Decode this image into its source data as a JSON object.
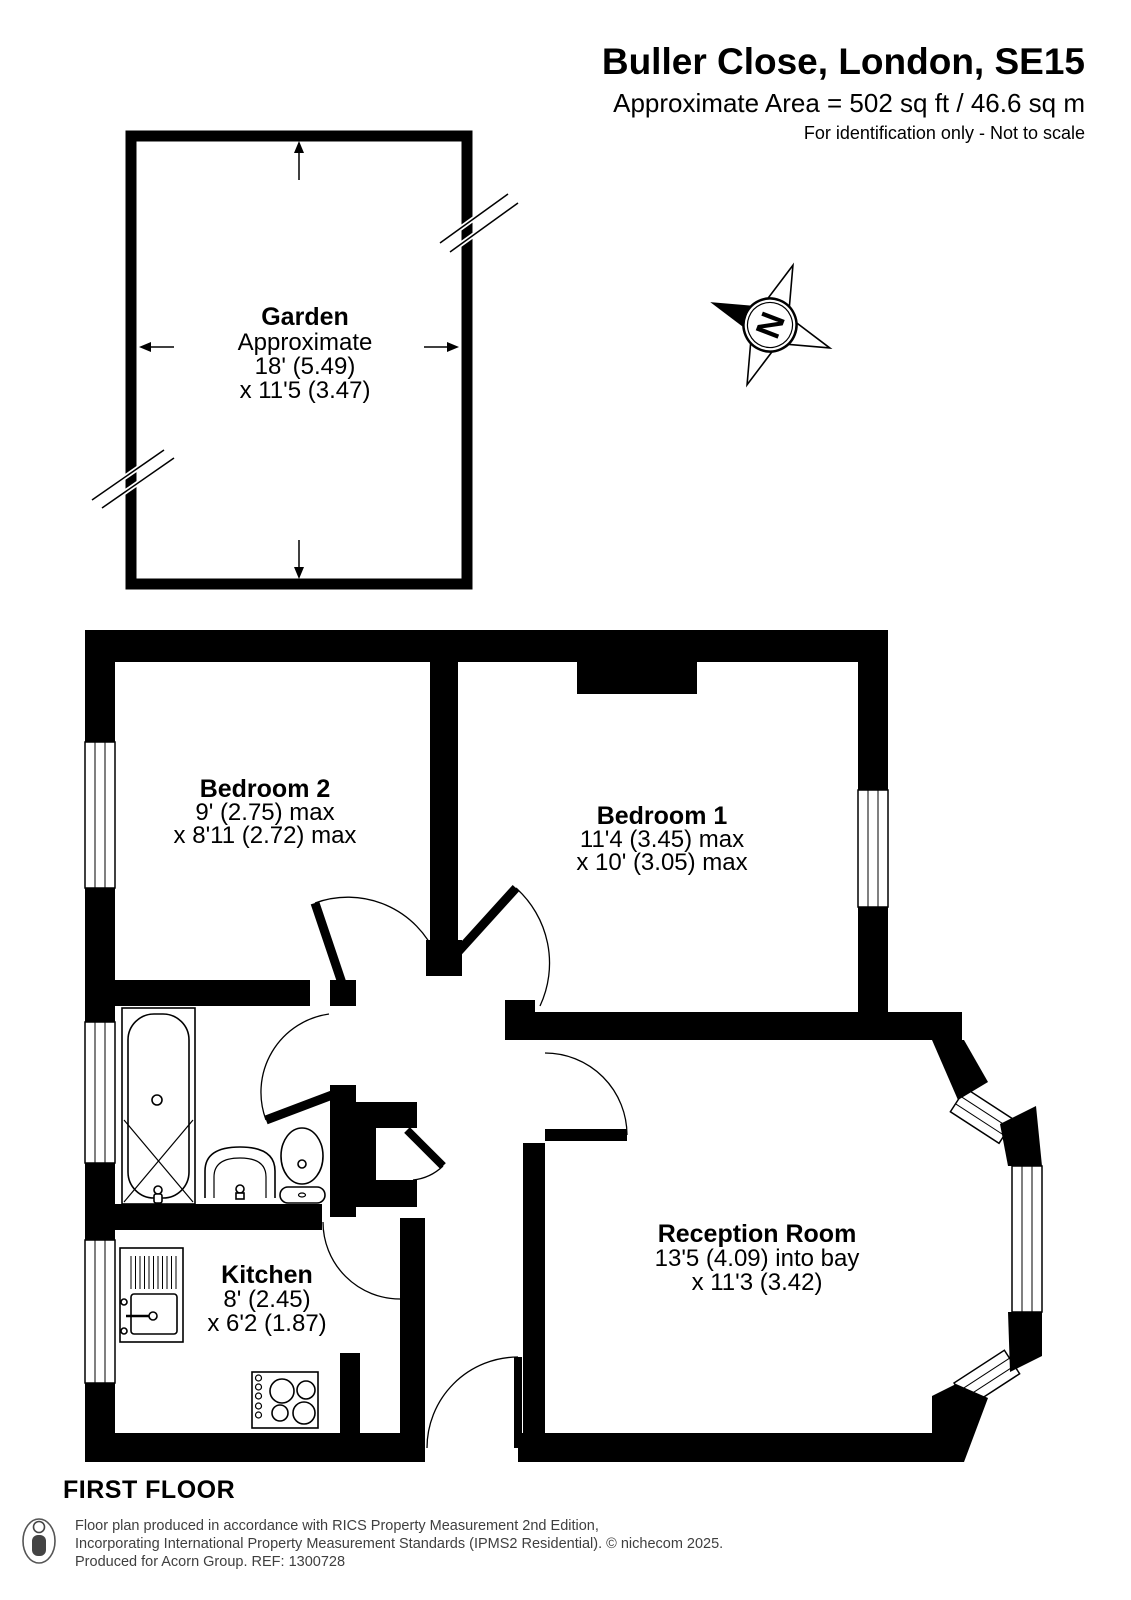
{
  "header": {
    "title": "Buller Close, London, SE15",
    "area": "Approximate Area = 502 sq ft / 46.6 sq m",
    "note": "For identification only - Not to scale"
  },
  "compass": {
    "north": "N"
  },
  "garden": {
    "name": "Garden",
    "line2": "Approximate",
    "line3": "18' (5.49)",
    "line4": "x 11'5 (3.47)"
  },
  "rooms": {
    "bedroom2": {
      "name": "Bedroom 2",
      "dim1": "9' (2.75) max",
      "dim2": "x 8'11 (2.72) max"
    },
    "bedroom1": {
      "name": "Bedroom 1",
      "dim1": "11'4 (3.45) max",
      "dim2": "x 10' (3.05) max"
    },
    "reception": {
      "name": "Reception Room",
      "dim1": "13'5 (4.09) into bay",
      "dim2": "x 11'3 (3.42)"
    },
    "kitchen": {
      "name": "Kitchen",
      "dim1": "8' (2.45)",
      "dim2": "x 6'2 (1.87)"
    }
  },
  "floor_label": "FIRST FLOOR",
  "footer": {
    "line1": "Floor plan produced in accordance with RICS Property Measurement 2nd Edition,",
    "line2": "Incorporating International Property Measurement Standards (IPMS2 Residential).   © nichecom 2025.",
    "line3": "Produced for Acorn Group.   REF: 1300728"
  },
  "colors": {
    "wall": "#000000",
    "background": "#ffffff",
    "footer_text": "#3f3f3f"
  }
}
